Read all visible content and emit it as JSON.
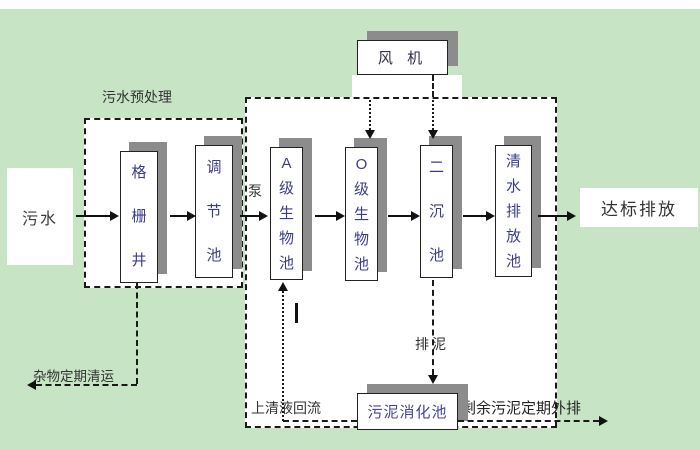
{
  "colors": {
    "background": "#c7e5c5",
    "panel": "#ffffff",
    "box_shadow": "#8c8c8c",
    "line": "#1a1a1a",
    "tank_text": "#3c3c8e",
    "label_text": "#333333"
  },
  "nodes": {
    "influent": "污水",
    "grid_well": "格栅井",
    "regulating_tank": "调节池",
    "a_bio_tank": "A级生物池",
    "o_bio_tank": "O级生物池",
    "secondary_tank": "二沉池",
    "clear_water_tank": "清水排放池",
    "fan": "风 机",
    "sludge_digester": "污泥消化池",
    "discharge": "达标排放"
  },
  "labels": {
    "pretreat_section": "污水预处理",
    "pump": "泵",
    "debris_removal": "杂物定期清运",
    "supernatant_return": "上清液回流",
    "sludge_discharge": "排泥",
    "excess_sludge": "剩余污泥定期外排"
  },
  "edges": [
    {
      "from": "influent",
      "to": "grid_well",
      "style": "solid"
    },
    {
      "from": "grid_well",
      "to": "regulating_tank",
      "style": "solid"
    },
    {
      "from": "regulating_tank",
      "to": "a_bio_tank",
      "style": "solid",
      "label_key": "pump"
    },
    {
      "from": "a_bio_tank",
      "to": "o_bio_tank",
      "style": "solid"
    },
    {
      "from": "o_bio_tank",
      "to": "secondary_tank",
      "style": "solid"
    },
    {
      "from": "secondary_tank",
      "to": "clear_water_tank",
      "style": "solid"
    },
    {
      "from": "clear_water_tank",
      "to": "discharge",
      "style": "solid"
    },
    {
      "from": "fan",
      "to": "o_bio_tank",
      "style": "dash-dot"
    },
    {
      "from": "fan",
      "to": "secondary_tank",
      "style": "dash-dot"
    },
    {
      "from": "grid_well",
      "to": "outside-left",
      "style": "dashed",
      "label_key": "debris_removal"
    },
    {
      "from": "secondary_tank",
      "to": "sludge_digester",
      "style": "dashed",
      "label_key": "sludge_discharge"
    },
    {
      "from": "sludge_digester",
      "to": "a_bio_tank",
      "style": "dotted",
      "label_key": "supernatant_return"
    },
    {
      "from": "sludge_digester",
      "to": "outside-right",
      "style": "dashed",
      "label_key": "excess_sludge"
    }
  ]
}
